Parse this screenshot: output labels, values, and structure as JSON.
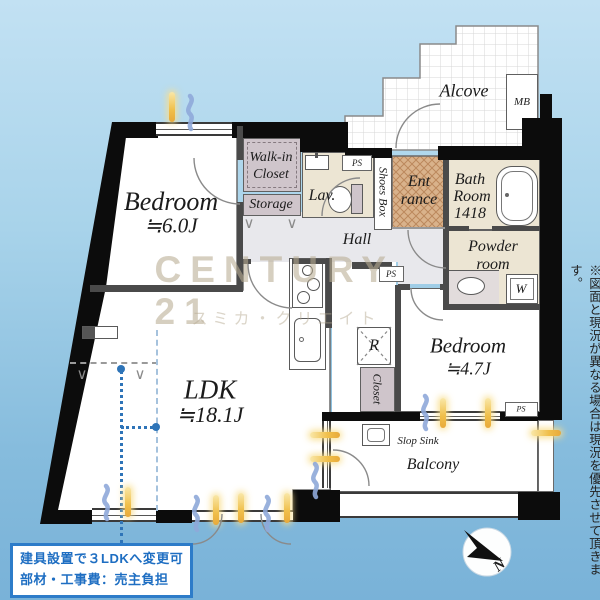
{
  "rooms": {
    "bedroom_main": {
      "name": "Bedroom",
      "size": "≒6.0J"
    },
    "ldk": {
      "name": "LDK",
      "size": "≒18.1J"
    },
    "bedroom_second": {
      "name": "Bedroom",
      "size": "≒4.7J"
    },
    "walk_in_closet": {
      "line1": "Walk-in",
      "line2": "Closet"
    },
    "storage": {
      "name": "Storage"
    },
    "lavatory": {
      "name": "Lav."
    },
    "hall": {
      "name": "Hall"
    },
    "entrance": {
      "line1": "Ent",
      "line2": "rance"
    },
    "shoes_box": {
      "name": "Shoes Box"
    },
    "bath": {
      "line1": "Bath",
      "line2": "Room",
      "line3": "1418"
    },
    "powder": {
      "line1": "Powder",
      "line2": "room"
    },
    "alcove": {
      "name": "Alcove"
    },
    "balcony": {
      "name": "Balcony"
    },
    "closet": {
      "name": "Closet"
    },
    "slop_sink": {
      "name": "Slop Sink"
    }
  },
  "labels": {
    "mb": "MB",
    "ps": "PS",
    "w": "W",
    "r": "R",
    "north": "N"
  },
  "watermark": {
    "brand": "CENTURY 21",
    "agency": "スミカ・クリエイト"
  },
  "notice": {
    "line1": "建具設置で３LDKへ変更可",
    "line2": "部材・工事費：売主負担"
  },
  "disclaimer": "※図面と現況が異なる場合は現況を優先させて頂きます。",
  "colors": {
    "wall": "#0c0c0c",
    "hall_gray": "#e8e8ec",
    "room_cream": "#ece5d3",
    "closet_mauve": "#cfc5cb",
    "notice_blue": "#1e6ec2",
    "sun_icon": "#f0bf4a",
    "wind_icon": "#8fa9d9",
    "background_sky": "#a8d3ea"
  }
}
